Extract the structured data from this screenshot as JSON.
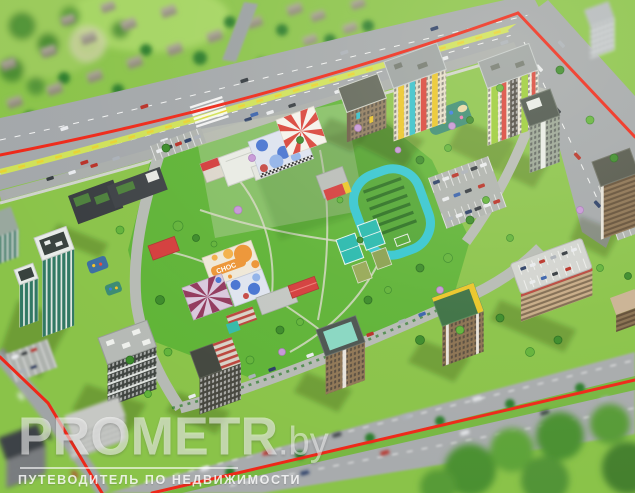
{
  "image": {
    "type": "aerial-3d-render",
    "subject": "residential complex master plan with red site boundary, central courtyard schools, stadium and surrounding streets"
  },
  "watermark": {
    "brand": "PROMETR",
    "domain": ".by",
    "tagline": "ПУТЕВОДИТЕЛЬ ПО НЕДВИЖИМОСТИ"
  },
  "labels": {
    "kindergarten_roof_text": "CHOC"
  },
  "palette": {
    "boundary_red": "#e52a1c",
    "grass_base": "#8cc24f",
    "lawn_green": "#62b23c",
    "asphalt": "#a3a7aa",
    "asphalt_light": "#b6bab4",
    "track_teal": "#3cc4cf",
    "court_teal": "#2fb7ad",
    "roof_red": "#cd3f3f",
    "accent_yellow": "#e8c530",
    "accent_cyan": "#3bbfc9",
    "accent_red": "#d2453c",
    "accent_lime": "#9ccb3f",
    "glass_teal": "#256e58",
    "median_lime": "#cfe060",
    "watermark_white": "#ffffff"
  }
}
